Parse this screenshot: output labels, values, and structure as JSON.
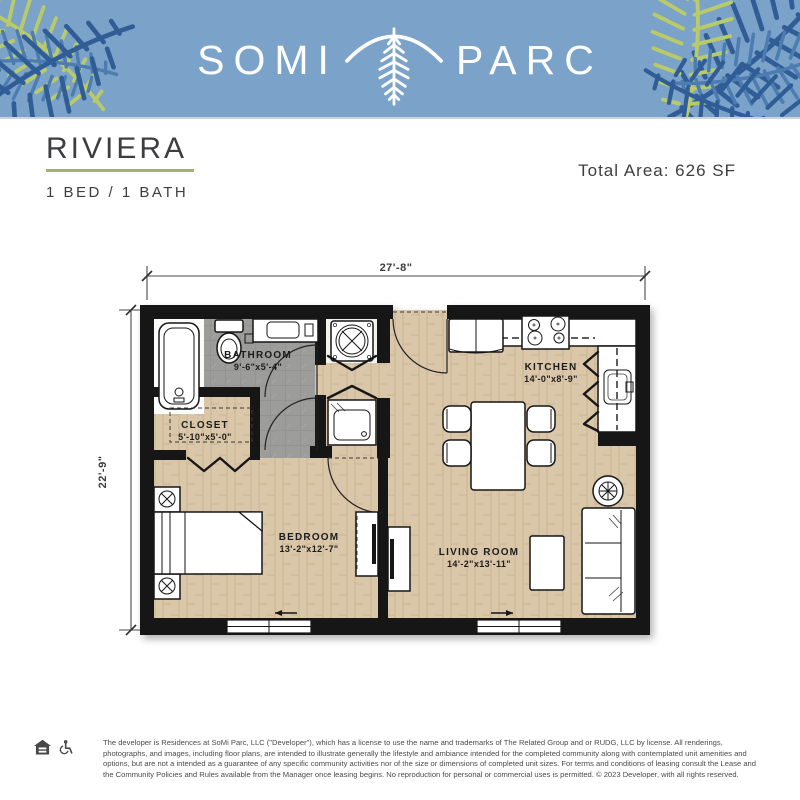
{
  "header": {
    "brand_left": "SOMI",
    "brand_right": "PARC"
  },
  "plan": {
    "name": "RIVIERA",
    "bed_bath": "1 BED / 1 BATH",
    "total_area": "Total Area: 626 SF"
  },
  "dimensions": {
    "width": "27'-8\"",
    "height": "22'-9\""
  },
  "rooms": {
    "bathroom": {
      "name": "BATHROOM",
      "size": "9'-6\"x5'-4\""
    },
    "closet": {
      "name": "CLOSET",
      "size": "5'-10\"x5'-0\""
    },
    "kitchen": {
      "name": "KITCHEN",
      "size": "14'-0\"x8'-9\""
    },
    "bedroom": {
      "name": "BEDROOM",
      "size": "13'-2\"x12'-7\""
    },
    "living": {
      "name": "LIVING ROOM",
      "size": "14'-2\"x13'-11\""
    }
  },
  "footer": {
    "disclaimer": "The developer is Residences at SoMi Parc, LLC (\"Developer\"), which has a license to use the name and trademarks of The Related Group and or RUDG, LLC by license. All renderings, photographs, and images, including floor plans, are intended to illustrate generally the lifestyle and ambiance intended for the completed community along with contemplated unit amenities and options, but are not a intended as a guarantee of any specific community activities nor of the size or dimensions of completed unit sizes. For terms and conditions of leasing consult the Lease and the Community Policies and Rules available from the Manager once leasing begins. No reproduction for personal or commercial uses is permitted. © 2023 Developer, with all rights reserved."
  },
  "colors": {
    "header_bg": "#7ba2c9",
    "palm_dark": "#305d96",
    "palm_mid": "#4d7cb0",
    "palm_light": "#b9ca69",
    "accent_green": "#a2b46c",
    "ink": "#3e3e40",
    "plan_wall": "#171717",
    "floor_wood": "#dac6a8",
    "floor_tile": "#9c9c9a",
    "dim_gray": "#4a4a4a",
    "footer_text": "#4b4b4b"
  }
}
